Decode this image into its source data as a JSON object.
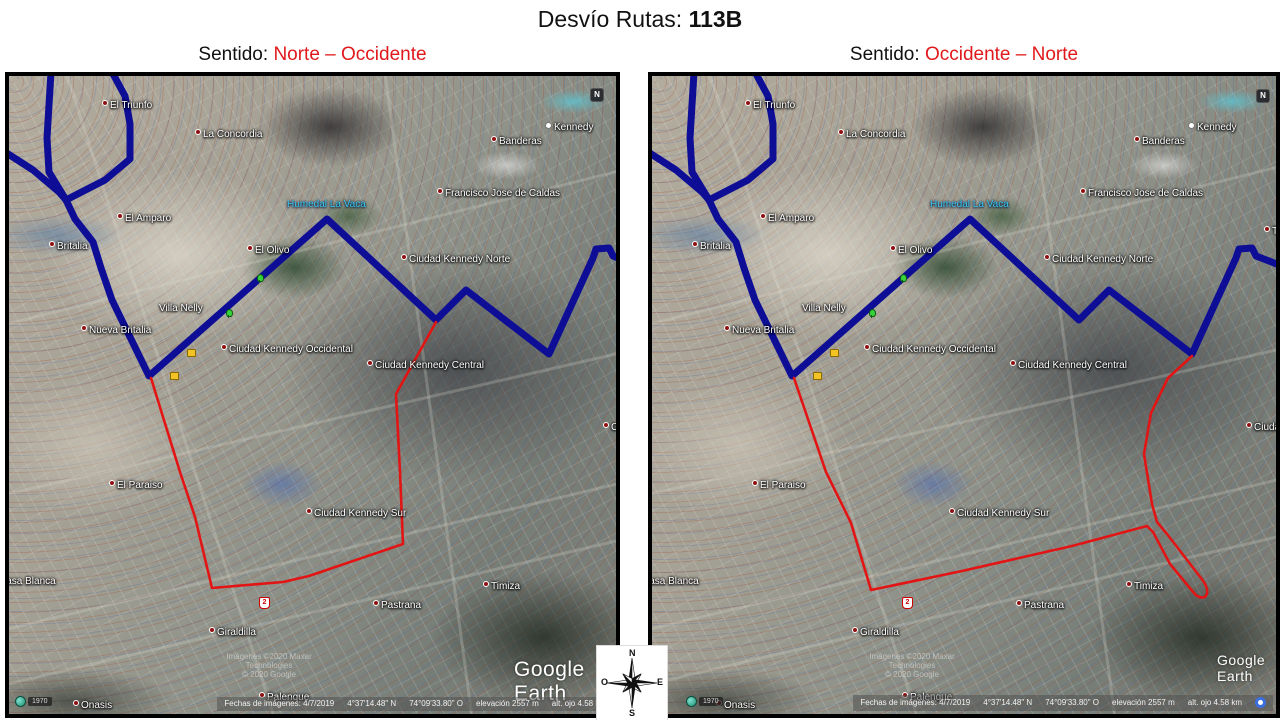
{
  "slide": {
    "title_prefix": "Desvío Rutas: ",
    "title_route": "113B"
  },
  "panels": [
    {
      "key": "left",
      "sentido_label": "Sentido:",
      "sentido_value": "Norte – Occidente",
      "red_route": "red_left",
      "nav_n_x": 581,
      "brand_x": 505,
      "brand_size": 21,
      "era_x": 22,
      "google_o": false
    },
    {
      "key": "right",
      "sentido_label": "Sentido:",
      "sentido_value": "Occidente – Norte",
      "red_route": "red_right",
      "nav_n_x": 604,
      "brand_x": 565,
      "brand_size": 14,
      "era_x": 50,
      "google_o": true
    }
  ],
  "map": {
    "labels": [
      {
        "t": "El Triunfo",
        "x": 93,
        "y": 24,
        "dot": 1
      },
      {
        "t": "La Concordia",
        "x": 186,
        "y": 53,
        "dot": 1
      },
      {
        "t": "Kennedy",
        "x": 536,
        "y": 46,
        "pin": 1
      },
      {
        "t": "Banderas",
        "x": 482,
        "y": 60,
        "dot": 1
      },
      {
        "t": "Francisco Jose de Caldas",
        "x": 428,
        "y": 112,
        "dot": 1
      },
      {
        "t": "Techo",
        "x": 612,
        "y": 150,
        "dot": 1
      },
      {
        "t": "El Amparo",
        "x": 108,
        "y": 137,
        "dot": 1
      },
      {
        "t": "Britalia",
        "x": 40,
        "y": 165,
        "dot": 1
      },
      {
        "t": "Humedal La Vaca",
        "x": 278,
        "y": 124,
        "c": "water"
      },
      {
        "t": "El Olivo",
        "x": 238,
        "y": 169,
        "dot": 1
      },
      {
        "t": "Ciudad Kennedy Norte",
        "x": 392,
        "y": 178,
        "dot": 1
      },
      {
        "t": "Villa Nelly",
        "x": 150,
        "y": 228
      },
      {
        "t": "Nueva Britalia",
        "x": 72,
        "y": 249,
        "dot": 1
      },
      {
        "t": "Ciudad Kennedy Occidental",
        "x": 212,
        "y": 268,
        "dot": 1
      },
      {
        "t": "Ciudad Kennedy Central",
        "x": 358,
        "y": 284,
        "dot": 1
      },
      {
        "t": "Ciudad",
        "x": 594,
        "y": 346,
        "dot": 1
      },
      {
        "t": "El Paraiso",
        "x": 100,
        "y": 404,
        "dot": 1
      },
      {
        "t": "Ciudad Kennedy Sur",
        "x": 297,
        "y": 432,
        "dot": 1
      },
      {
        "t": "Casa Blanca",
        "x": -10,
        "y": 501
      },
      {
        "t": "Pastrana",
        "x": 364,
        "y": 524,
        "dot": 1
      },
      {
        "t": "Timiza",
        "x": 474,
        "y": 505,
        "dot": 1
      },
      {
        "t": "Giraldilla",
        "x": 200,
        "y": 551,
        "dot": 1
      },
      {
        "t": "Onasis",
        "x": 64,
        "y": 624,
        "dot": 1
      },
      {
        "t": "Palenque",
        "x": 250,
        "y": 616,
        "dot": 1
      }
    ],
    "trees": [
      {
        "x": 247,
        "y": 198
      },
      {
        "x": 216,
        "y": 233
      }
    ],
    "yellow_markers": [
      {
        "x": 178,
        "y": 273
      },
      {
        "x": 161,
        "y": 296
      }
    ],
    "route_shield": {
      "t": "2",
      "x": 250,
      "y": 521
    },
    "watermark_line1": "Imágenes ©2020 Maxar Technologies",
    "watermark_line2": "© 2020 Google",
    "brand": "Google Earth",
    "era": "1970",
    "nav_n": "N",
    "status": [
      "Fechas de imágenes: 4/7/2019",
      "4°37'14.48\" N",
      "74°09'33.80\" O",
      "elevación 2557 m",
      "alt. ojo  4.58 km"
    ]
  },
  "routes": {
    "blue": {
      "color": "#0d0d96",
      "width": 7,
      "paths": [
        "M42 -4 L38 62 L40 96 L57 124",
        "M103 -4 L116 20 L121 48 L121 83 L96 104 L57 124",
        "M-4 76 L24 94 L50 116 L57 124",
        "M57 124 L66 143 L84 166 L92 192 L103 224 L140 300 L318 143 L427 244 L457 214 L540 278 L584 182 L587 173 L600 172 L604 180 L648 197"
      ]
    },
    "red_left": {
      "color": "#e21414",
      "width": 2.6,
      "paths": [
        "M427 246 L387 318 L391 396 L394 468 L300 500 L274 506 L203 512 L186 441 L171 396 L142 302"
      ]
    },
    "red_right": {
      "color": "#e21414",
      "width": 2.6,
      "paths": [
        "M540 280 L516 302 L499 337 L492 378 L500 428 L505 446 L515 458 L549 502 Q559 515 553 521 Q547 523 542 517 L518 488 L501 456 L495 450 L420 470 L310 495 L219 514 L199 447 L174 396 L142 302"
      ]
    },
    "roads": {
      "color": "#dcdad0",
      "width": 3,
      "opacity": 0.25,
      "paths": [
        "M-10 555 L650 398",
        "M-10 610 L650 455",
        "M55 -10 L270 656",
        "M375 -10 L465 656",
        "M-10 250 L650 85",
        "M-10 420 L650 268"
      ]
    }
  },
  "compass": {
    "n": "N",
    "s": "S",
    "e": "E",
    "o": "O"
  }
}
